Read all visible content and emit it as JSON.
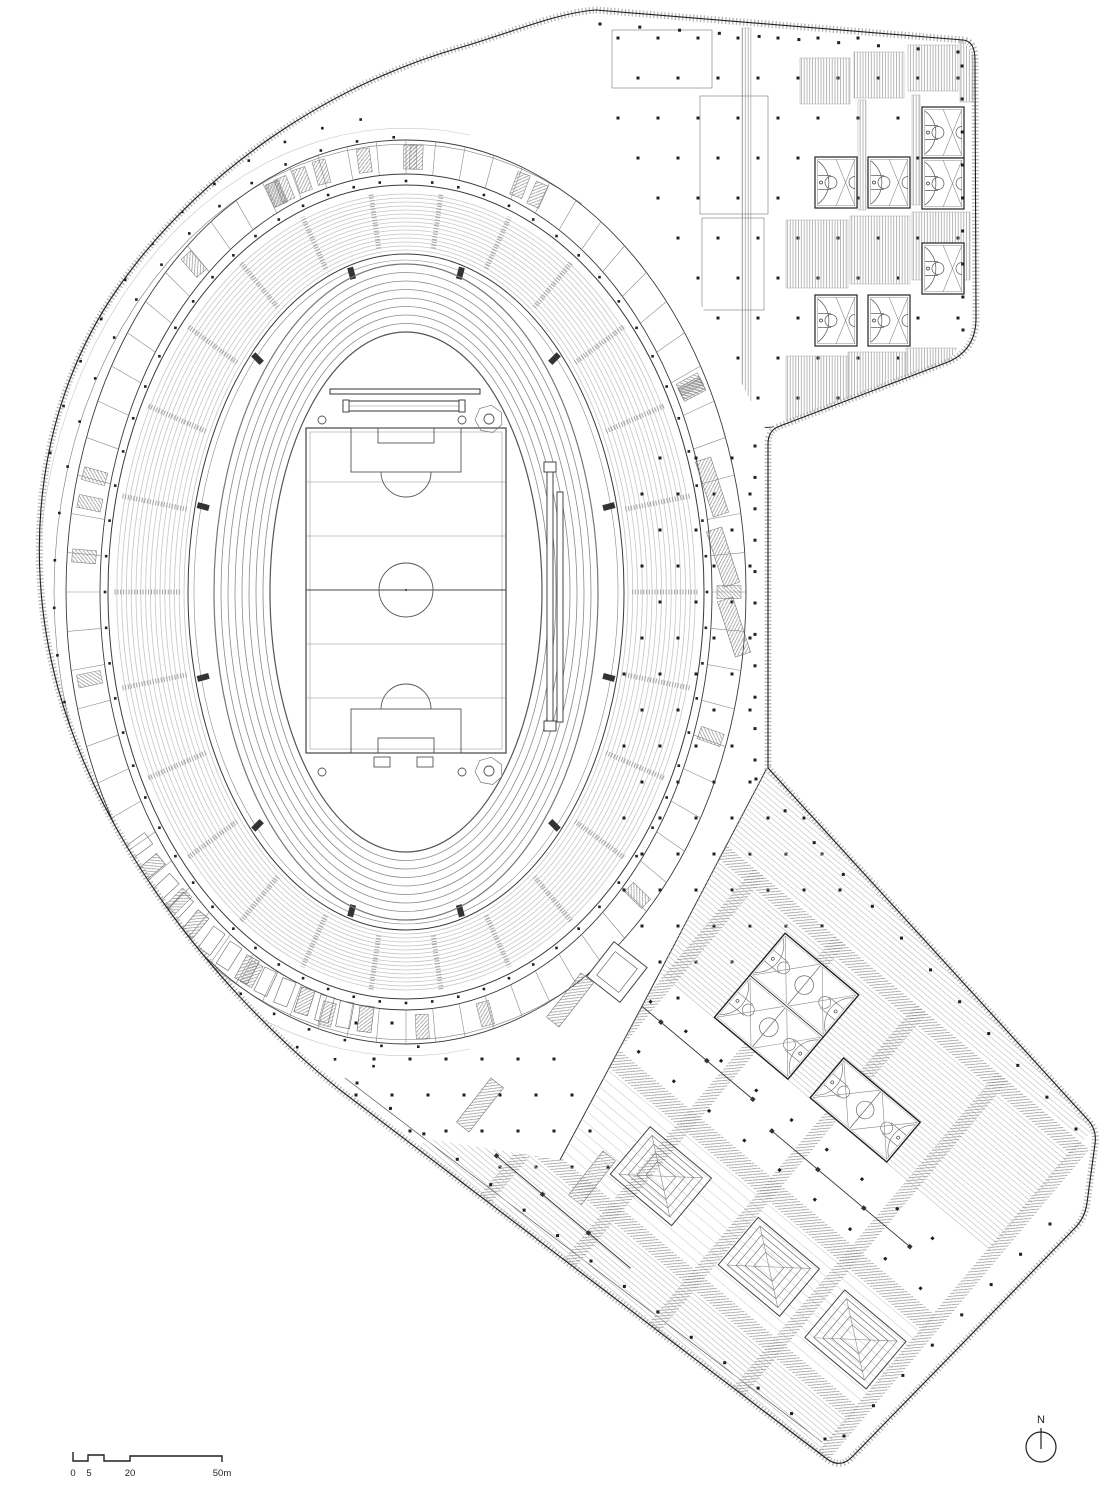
{
  "drawing": {
    "type": "architectural-floor-plan",
    "subject": "stadium-and-sports-complex",
    "labels": {
      "north": "N"
    },
    "scale_bar": {
      "ticks": [
        "0",
        "5",
        "20",
        "50m"
      ],
      "unit": "m"
    },
    "palette": {
      "paper": "#ffffff",
      "ink": "#1f1f1f",
      "dark": "#3a3a3a",
      "mid": "#8a8a8a",
      "light": "#c6c6c6",
      "faint": "#dcdcdc",
      "hatch": "#9a9a9a",
      "band": "#b8b8b8"
    },
    "track": {
      "lanes": 8
    },
    "stands": {
      "rows": 15,
      "aisles": 26,
      "vomitories": 12
    },
    "ring": {
      "room_ticks": 72,
      "room_blocks": 26
    },
    "field": {
      "grid_lines": 4
    },
    "upper_wing": {
      "half_courts": 7
    },
    "lower_wing": {
      "skylights": 3,
      "courts": 3
    }
  }
}
